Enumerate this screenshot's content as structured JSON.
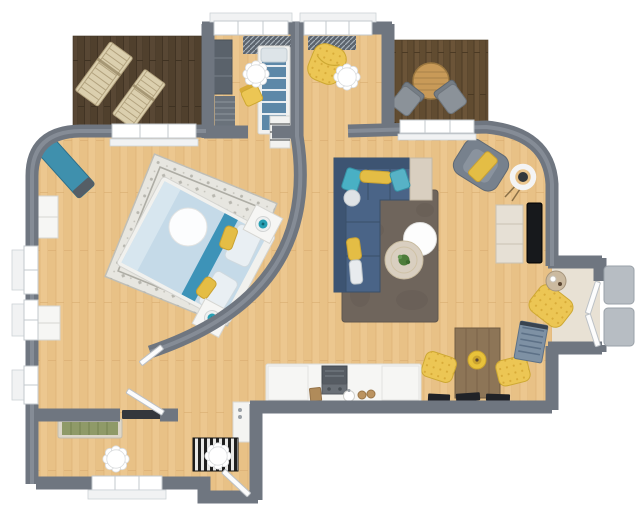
{
  "scene": {
    "type": "3d-floor-plan",
    "view": "top-down",
    "description": "3D rendered top-down floor plan of a one-bedroom apartment with two wood balconies, curved interior wall around the bedroom, living room, dining area, kitchenette and entry vestibule"
  },
  "palette": {
    "background": "#ffffff",
    "floor": "#ecc78f",
    "floor_line": "#d8ab70",
    "wall": "#6f7680",
    "wall_highlight": "#9ba2ab",
    "window_frame": "#c3c8cd",
    "deck_left": "#584734",
    "deck_right": "#6b5438",
    "sofa": "#4a6487",
    "sofa_dark": "#3d5472",
    "living_rug": "#6f655c",
    "bed_duvet": "#c5dae8",
    "bed_stripe": "#3d93b8",
    "bedroom_rug": "#e7e6e0",
    "pillow_yellow": "#e4bd45",
    "chair_yellow": "#ecc654",
    "quilt_dot": "#d8ab38",
    "teal_accent": "#3f90ad",
    "lamp_teal": "#27a0b4",
    "white_furniture": "#f6f6f4",
    "beige_wood": "#d9cfc0",
    "dining_table": "#8d7557",
    "balcony_table": "#c89a58",
    "outdoor_chair": "#8b9299",
    "tv": "#17191c",
    "radiator": "#7e91a4",
    "bench_cushion": "#8f9a68",
    "steps": "#b7bdc3",
    "appliance": "#565c63",
    "plant": "#4d7c3a",
    "mat_dark": "#1f1f1f",
    "mat_light": "#e9e9e7",
    "door": "#fcfcfc",
    "vestibule_floor": "#e8e1d4"
  },
  "rooms": [
    {
      "name": "bedroom",
      "furniture": [
        "double-bed",
        "patterned-area-rug",
        "nightstand",
        "nightstand",
        "teal-table-lamp",
        "teal-table-lamp",
        "teal-storage-bench",
        "dresser",
        "dresser",
        "ceiling-light"
      ]
    },
    {
      "name": "living-room",
      "furniture": [
        "navy-corner-sofa",
        "accent-pillows",
        "chaise-end-table",
        "shag-rug",
        "round-coffee-table-white",
        "round-side-table-with-plant",
        "gray-armchair",
        "ring-floor-lamp",
        "sideboard",
        "wall-tv"
      ]
    },
    {
      "name": "dining-area",
      "furniture": [
        "wooden-dining-table",
        "fruit-bowl",
        "yellow-upholstered-chair",
        "yellow-upholstered-chair",
        "yellow-quilted-armchair",
        "round-side-table",
        "wall-radiator",
        "wall-shelf-items"
      ]
    },
    {
      "name": "kitchen",
      "furniture": [
        "white-counter-unit",
        "range-with-hood",
        "round-sink",
        "cutting-board",
        "refrigerator-cabinet"
      ]
    },
    {
      "name": "dressing-room",
      "furniture": [
        "daybed",
        "dark-wardrobe",
        "slat-rack",
        "yellow-chair",
        "window-radiator",
        "scalloped-ceiling-light",
        "shelf-unit"
      ]
    },
    {
      "name": "lounge-nook",
      "furniture": [
        "yellow-bean-bag-chair",
        "window-radiator",
        "scalloped-ceiling-light"
      ]
    },
    {
      "name": "balcony-left",
      "furniture": [
        "wooden-sun-lounger",
        "wooden-sun-lounger"
      ]
    },
    {
      "name": "balcony-right",
      "furniture": [
        "round-outdoor-table",
        "outdoor-chair",
        "outdoor-chair"
      ]
    },
    {
      "name": "entry-vestibule",
      "furniture": [
        "double-entry-door",
        "outdoor-step",
        "outdoor-step",
        "side-table"
      ]
    },
    {
      "name": "hallway",
      "furniture": [
        "green-slat-bench",
        "dark-wall-shelf",
        "striped-doormat",
        "scalloped-ceiling-light",
        "scalloped-ceiling-light",
        "interior-door",
        "interior-door",
        "entry-door"
      ]
    }
  ]
}
